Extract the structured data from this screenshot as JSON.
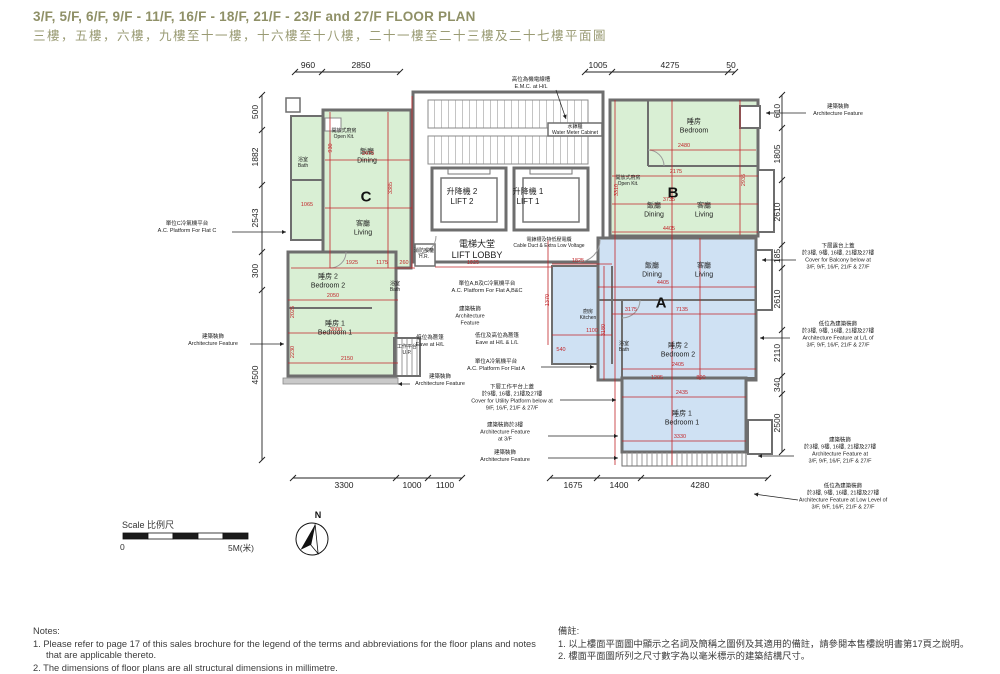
{
  "title": {
    "en": "3/F, 5/F, 6/F, 9/F - 11/F, 16/F - 18/F, 21/F - 23/F and 27/F FLOOR PLAN",
    "zh": "三樓，五樓，六樓，九樓至十一樓，十六樓至十八樓，二十一樓至二十三樓及二十七樓平面圖"
  },
  "colors": {
    "flat_green": "#d9efd4",
    "flat_blue": "#cfe1f3",
    "wall": "#6e6e6e",
    "dim_red": "#c2262a",
    "title_olive": "#8f9067"
  },
  "scale": {
    "label": "Scale 比例尺",
    "zero": "0",
    "max": "5M(米)"
  },
  "compass": {
    "north": "N"
  },
  "notes": {
    "en": {
      "heading": "Notes:",
      "items": [
        "1. Please refer to page 17 of this sales brochure for the legend of the terms and abbreviations for the floor plans and notes that are applicable thereto.",
        "2. The dimensions of floor plans are all structural dimensions in millimetre."
      ]
    },
    "zh": {
      "heading": "備註:",
      "items": [
        "1. 以上樓面平面圖中顯示之名詞及簡稱之圖例及其適用的備註，請參閱本售樓說明書第17頁之說明。",
        "2. 樓面平面圖所列之尺寸數字為以毫米標示的建築結構尺寸。"
      ]
    }
  },
  "plan": {
    "flat_letters": [
      {
        "t": "C",
        "x": 366,
        "y": 197
      },
      {
        "t": "B",
        "x": 673,
        "y": 193
      },
      {
        "t": "A",
        "x": 661,
        "y": 303
      }
    ],
    "room_labels": [
      {
        "lines": [
          "飯廳",
          "Dining"
        ],
        "x": 367,
        "y": 157
      },
      {
        "lines": [
          "客廳",
          "Living"
        ],
        "x": 363,
        "y": 229
      },
      {
        "lines": [
          "睡房 2",
          "Bedroom 2"
        ],
        "x": 328,
        "y": 282
      },
      {
        "lines": [
          "睡房 1",
          "Bedroom 1"
        ],
        "x": 335,
        "y": 329
      },
      {
        "lines": [
          "睡房",
          "Bedroom"
        ],
        "x": 694,
        "y": 127
      },
      {
        "lines": [
          "飯廳",
          "Dining"
        ],
        "x": 654,
        "y": 211
      },
      {
        "lines": [
          "客廳",
          "Living"
        ],
        "x": 704,
        "y": 211
      },
      {
        "lines": [
          "飯廳",
          "Dining"
        ],
        "x": 652,
        "y": 271
      },
      {
        "lines": [
          "客廳",
          "Living"
        ],
        "x": 704,
        "y": 271
      },
      {
        "lines": [
          "睡房 2",
          "Bedroom 2"
        ],
        "x": 678,
        "y": 351
      },
      {
        "lines": [
          "睡房 1",
          "Bedroom 1"
        ],
        "x": 682,
        "y": 419
      },
      {
        "lines": [
          "升降機 2",
          "LIFT 2"
        ],
        "x": 462,
        "y": 197,
        "s": 8
      },
      {
        "lines": [
          "升降機 1",
          "LIFT 1"
        ],
        "x": 528,
        "y": 197,
        "s": 8
      },
      {
        "lines": [
          "電梯大堂",
          "LIFT LOBBY"
        ],
        "x": 477,
        "y": 250,
        "s": 9
      }
    ],
    "small_labels": [
      {
        "lines": [
          "開放式廚房",
          "Open Kit."
        ],
        "x": 344,
        "y": 134
      },
      {
        "lines": [
          "浴室",
          "Bath"
        ],
        "x": 303,
        "y": 163
      },
      {
        "lines": [
          "浴室",
          "Bath"
        ],
        "x": 395,
        "y": 287
      },
      {
        "lines": [
          "工作平台",
          "U.P."
        ],
        "x": 407,
        "y": 350
      },
      {
        "lines": [
          "開放式廚房",
          "Open Kit."
        ],
        "x": 628,
        "y": 181
      },
      {
        "lines": [
          "水錶櫃",
          "Water Meter Cabinet"
        ],
        "x": 575,
        "y": 130
      },
      {
        "lines": [
          "電錶槽及特低壓電纜",
          "Cable Duct & Extra Low Voltage"
        ],
        "x": 549,
        "y": 243
      },
      {
        "lines": [
          "消防喉轆",
          "H.R."
        ],
        "x": 424,
        "y": 254
      },
      {
        "lines": [
          "廚房",
          "Kitchen"
        ],
        "x": 588,
        "y": 315
      },
      {
        "lines": [
          "浴室",
          "Bath"
        ],
        "x": 624,
        "y": 347
      }
    ],
    "annotations": [
      {
        "lines": [
          "單位C冷氣機平台",
          "A.C. Platform For Flat C"
        ],
        "x": 187,
        "y": 228
      },
      {
        "lines": [
          "建築裝飾",
          "Architecture Feature"
        ],
        "x": 213,
        "y": 341
      },
      {
        "lines": [
          "高位為機電線槽",
          "E.M.C. at H/L"
        ],
        "x": 531,
        "y": 84
      },
      {
        "lines": [
          "單位A,B及C冷氣機平台",
          "A.C. Platform For Flat A,B&C"
        ],
        "x": 487,
        "y": 288
      },
      {
        "lines": [
          "建築裝飾",
          "Architecture",
          "Feature"
        ],
        "x": 470,
        "y": 317
      },
      {
        "lines": [
          "低位為簷篷",
          "Eave at H/L"
        ],
        "x": 430,
        "y": 342
      },
      {
        "lines": [
          "低位及高位為簷篷",
          "Eave at H/L & L/L"
        ],
        "x": 497,
        "y": 340
      },
      {
        "lines": [
          "單位A冷氣機平台",
          "A.C. Platform For Flat A"
        ],
        "x": 496,
        "y": 366
      },
      {
        "lines": [
          "下層工作平台上蓋",
          "於9樓, 16樓, 21樓及27樓",
          "Cover for Utility Platform below at",
          "9/F, 16/F, 21/F & 27/F"
        ],
        "x": 512,
        "y": 399
      },
      {
        "lines": [
          "建築裝飾於3樓",
          "Architecture Feature",
          "at 3/F"
        ],
        "x": 505,
        "y": 433
      },
      {
        "lines": [
          "建築裝飾",
          "Architecture Feature"
        ],
        "x": 505,
        "y": 457
      },
      {
        "lines": [
          "建築裝飾",
          "Architecture Feature"
        ],
        "x": 440,
        "y": 381
      },
      {
        "lines": [
          "建築裝飾",
          "Architecture Feature"
        ],
        "x": 838,
        "y": 111
      },
      {
        "lines": [
          "下層露台上蓋",
          "於3樓, 9樓, 16樓, 21樓及27樓",
          "Cover for Balcony below at",
          "3/F, 9/F, 16/F, 21/F & 27/F"
        ],
        "x": 838,
        "y": 258
      },
      {
        "lines": [
          "低位為建築裝飾",
          "於3樓, 9樓, 16樓, 21樓及27樓",
          "Architecture Feature at L/L of",
          "3/F, 9/F, 16/F, 21/F & 27/F"
        ],
        "x": 838,
        "y": 336
      },
      {
        "lines": [
          "建築裝飾",
          "於3樓, 9樓, 16樓, 21樓及27樓",
          "Architecture Feature at",
          "3/F, 9/F, 16/F, 21/F & 27/F"
        ],
        "x": 840,
        "y": 452
      },
      {
        "lines": [
          "低位為建築裝飾",
          "於3樓, 9樓, 16樓, 21樓及27樓",
          "Architecture Feature at Low Level of",
          "3/F, 9/F, 16/F, 21/F & 27/F"
        ],
        "x": 843,
        "y": 498
      }
    ],
    "red_dims": [
      {
        "t": "2475",
        "x": 368,
        "y": 154
      },
      {
        "t": "930",
        "x": 331,
        "y": 148,
        "r": 1
      },
      {
        "t": "3385",
        "x": 391,
        "y": 188,
        "r": 1
      },
      {
        "t": "1065",
        "x": 307,
        "y": 205
      },
      {
        "t": "1925",
        "x": 352,
        "y": 263
      },
      {
        "t": "1175",
        "x": 382,
        "y": 263
      },
      {
        "t": "260",
        "x": 404,
        "y": 263
      },
      {
        "t": "2050",
        "x": 333,
        "y": 296
      },
      {
        "t": "3000",
        "x": 336,
        "y": 330
      },
      {
        "t": "2150",
        "x": 347,
        "y": 359
      },
      {
        "t": "2025",
        "x": 293,
        "y": 312,
        "r": 1
      },
      {
        "t": "2230",
        "x": 293,
        "y": 352,
        "r": 1
      },
      {
        "t": "2480",
        "x": 684,
        "y": 146
      },
      {
        "t": "2175",
        "x": 676,
        "y": 172
      },
      {
        "t": "3735",
        "x": 669,
        "y": 200
      },
      {
        "t": "4405",
        "x": 669,
        "y": 229
      },
      {
        "t": "3310",
        "x": 617,
        "y": 190,
        "r": 1
      },
      {
        "t": "2935",
        "x": 744,
        "y": 180,
        "r": 1
      },
      {
        "t": "4405",
        "x": 663,
        "y": 283
      },
      {
        "t": "7135",
        "x": 682,
        "y": 310
      },
      {
        "t": "3175",
        "x": 631,
        "y": 310
      },
      {
        "t": "2405",
        "x": 678,
        "y": 365
      },
      {
        "t": "1205",
        "x": 657,
        "y": 378
      },
      {
        "t": "800",
        "x": 701,
        "y": 378
      },
      {
        "t": "2435",
        "x": 682,
        "y": 393
      },
      {
        "t": "3330",
        "x": 680,
        "y": 437
      },
      {
        "t": "1825",
        "x": 473,
        "y": 263
      },
      {
        "t": "1825",
        "x": 578,
        "y": 261
      },
      {
        "t": "1100",
        "x": 592,
        "y": 331
      },
      {
        "t": "540",
        "x": 561,
        "y": 350
      },
      {
        "t": "3180",
        "x": 604,
        "y": 330,
        "r": 1
      },
      {
        "t": "1370",
        "x": 548,
        "y": 300,
        "r": 1
      }
    ],
    "black_dims": [
      {
        "t": "960",
        "x": 308,
        "y": 65
      },
      {
        "t": "2850",
        "x": 361,
        "y": 65
      },
      {
        "t": "1005",
        "x": 598,
        "y": 65
      },
      {
        "t": "4275",
        "x": 670,
        "y": 65
      },
      {
        "t": "50",
        "x": 731,
        "y": 65
      },
      {
        "t": "500",
        "x": 255,
        "y": 112,
        "r": 1
      },
      {
        "t": "1882",
        "x": 255,
        "y": 157,
        "r": 1
      },
      {
        "t": "2543",
        "x": 255,
        "y": 218,
        "r": 1
      },
      {
        "t": "300",
        "x": 255,
        "y": 271,
        "r": 1
      },
      {
        "t": "4500",
        "x": 255,
        "y": 375,
        "r": 1
      },
      {
        "t": "610",
        "x": 777,
        "y": 111,
        "r": 1
      },
      {
        "t": "1805",
        "x": 777,
        "y": 154,
        "r": 1
      },
      {
        "t": "2610",
        "x": 777,
        "y": 212,
        "r": 1
      },
      {
        "t": "185",
        "x": 777,
        "y": 256,
        "r": 1
      },
      {
        "t": "2610",
        "x": 777,
        "y": 299,
        "r": 1
      },
      {
        "t": "2110",
        "x": 777,
        "y": 353,
        "r": 1
      },
      {
        "t": "340",
        "x": 777,
        "y": 385,
        "r": 1
      },
      {
        "t": "2500",
        "x": 777,
        "y": 423,
        "r": 1
      },
      {
        "t": "3300",
        "x": 344,
        "y": 485
      },
      {
        "t": "1000",
        "x": 412,
        "y": 485
      },
      {
        "t": "1100",
        "x": 445,
        "y": 485
      },
      {
        "t": "1675",
        "x": 573,
        "y": 485
      },
      {
        "t": "1400",
        "x": 619,
        "y": 485
      },
      {
        "t": "4280",
        "x": 700,
        "y": 485
      }
    ]
  }
}
